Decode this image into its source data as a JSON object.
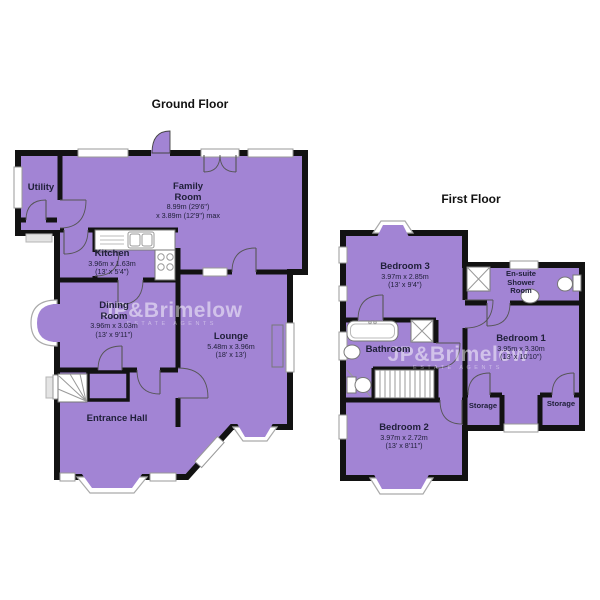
{
  "colors": {
    "floor_fill": "#a284d4",
    "wall": "#121212",
    "window_frame": "#999999",
    "label_text": "#20203a",
    "watermark": "rgba(255,255,255,0.5)"
  },
  "floors": {
    "ground": {
      "title": "Ground Floor",
      "rooms": {
        "utility": {
          "name": "Utility"
        },
        "family": {
          "name": "Family Room",
          "dim1": "8.99m (29'6\")",
          "dim2": "x 3.89m (12'9\") max"
        },
        "kitchen": {
          "name": "Kitchen",
          "dim1": "3.96m x 1.63m",
          "dim2": "(13' x 5'4\")"
        },
        "dining": {
          "name": "Dining Room",
          "dim1": "3.96m x 3.03m",
          "dim2": "(13' x 9'11\")"
        },
        "lounge": {
          "name": "Lounge",
          "dim1": "5.48m x 3.96m",
          "dim2": "(18' x 13')"
        },
        "hall": {
          "name": "Entrance Hall"
        }
      }
    },
    "first": {
      "title": "First Floor",
      "rooms": {
        "bedroom3": {
          "name": "Bedroom 3",
          "dim1": "3.97m x 2.85m",
          "dim2": "(13' x 9'4\")"
        },
        "ensuite": {
          "name": "En-suite Shower Room"
        },
        "bathroom": {
          "name": "Bathroom"
        },
        "bedroom1": {
          "name": "Bedroom 1",
          "dim1": "3.95m x 3.30m",
          "dim2": "(13' x 10'10\")"
        },
        "storage_left": {
          "name": "Storage"
        },
        "storage_right": {
          "name": "Storage"
        },
        "bedroom2": {
          "name": "Bedroom 2",
          "dim1": "3.97m x 2.72m",
          "dim2": "(13' x 8'11\")"
        }
      }
    }
  },
  "watermark": {
    "name": "JP&Brimelow",
    "tagline": "ESTATE AGENTS"
  }
}
